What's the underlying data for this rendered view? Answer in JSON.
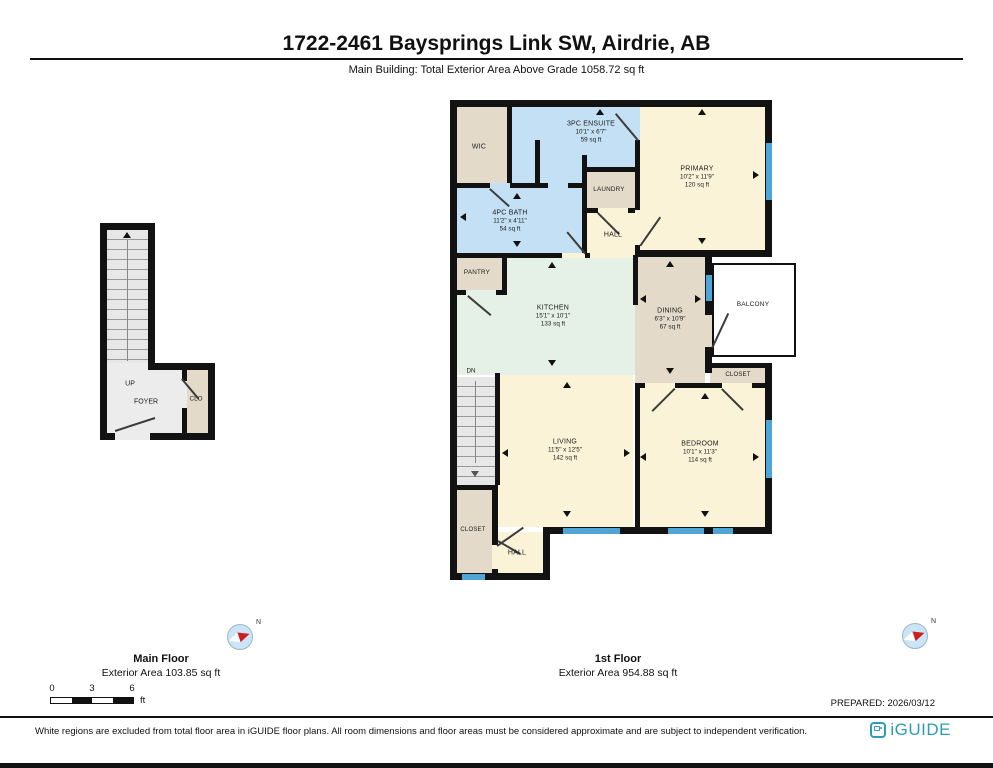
{
  "header": {
    "title": "1722-2461 Baysprings Link SW, Airdrie, AB",
    "subtitle": "Main Building: Total Exterior Area Above Grade 1058.72 sq ft"
  },
  "compass": {
    "label": "N"
  },
  "main_floor_plan": {
    "stairs_direction": "UP",
    "foyer": "FOYER",
    "closet": "CLO",
    "caption_title": "Main Floor",
    "caption_area": "Exterior Area 103.85 sq ft"
  },
  "first_floor_plan": {
    "caption_title": "1st Floor",
    "caption_area": "Exterior Area 954.88 sq ft",
    "stairs_direction": "DN",
    "rooms": {
      "wic": {
        "label": "WIC"
      },
      "ensuite": {
        "label": "3PC ENSUITE",
        "dims": "10'1\" x 6'7\"",
        "area": "59 sq ft"
      },
      "primary": {
        "label": "PRIMARY",
        "dims": "10'2\" x 11'9\"",
        "area": "120 sq ft"
      },
      "laundry": {
        "label": "LAUNDRY"
      },
      "hall_upper": {
        "label": "HALL"
      },
      "bath": {
        "label": "4PC BATH",
        "dims": "11'2\" x 4'11\"",
        "area": "54 sq ft"
      },
      "pantry": {
        "label": "PANTRY"
      },
      "kitchen": {
        "label": "KITCHEN",
        "dims": "15'1\" x 10'1\"",
        "area": "133 sq ft"
      },
      "dining": {
        "label": "DINING",
        "dims": "6'3\" x 10'9\"",
        "area": "67 sq ft"
      },
      "balcony": {
        "label": "BALCONY"
      },
      "closet_upper": {
        "label": "CLOSET"
      },
      "living": {
        "label": "LIVING",
        "dims": "11'5\" x 12'5\"",
        "area": "142 sq ft"
      },
      "bedroom": {
        "label": "BEDROOM",
        "dims": "10'1\" x 11'3\"",
        "area": "114 sq ft"
      },
      "closet_lower": {
        "label": "CLOSET"
      },
      "hall_lower": {
        "label": "HALL"
      }
    }
  },
  "scale_bar": {
    "ticks": [
      "0",
      "3",
      "6"
    ],
    "unit": "ft"
  },
  "prepared_label": "PREPARED: 2026/03/12",
  "footer": {
    "disclaimer": "White regions are excluded from total floor area in iGUIDE floor plans. All room dimensions and floor areas must be considered approximate and are subject to independent verification.",
    "brand": "iGUIDE"
  },
  "colors": {
    "wall": "#121212",
    "room_cream": "#FBF3D8",
    "room_tan": "#E3DACA",
    "room_blue": "#C3E0F4",
    "room_mint": "#E5F0E6",
    "stairs_gray": "#E7E7E7",
    "window_blue": "#4FA6D6",
    "brand_teal": "#2D9CB8"
  }
}
